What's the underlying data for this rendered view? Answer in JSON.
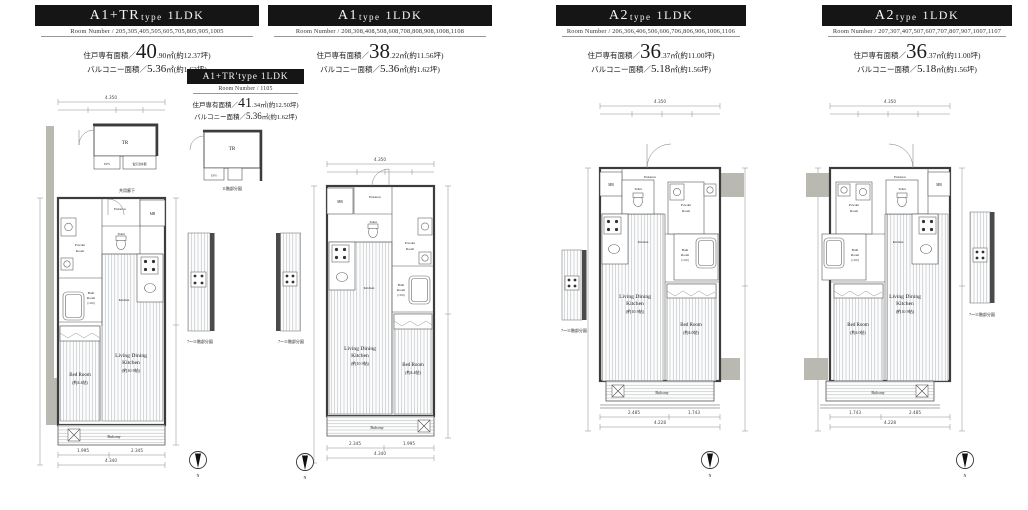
{
  "shared": {
    "compass_n": "N",
    "strip_caption": "7〜11階部分図",
    "tr11_caption": "11階部分図",
    "corridor_label": "共用廊下"
  },
  "plans": [
    {
      "type_big": "A1+TR",
      "type_small": "type",
      "type_tail": "1LDK",
      "room_numbers": "Room Number / 205,305,405,505,605,705,805,905,1005",
      "area_label": "住戸専有面積／",
      "area_int": "40",
      "area_rest": ".90㎡(約12.37坪)",
      "bal_label": "バルコニー面積／",
      "bal_val": "5.36",
      "bal_rest": "㎡(約1.62坪)",
      "rooms": {
        "tr": "TR",
        "eps": "EPS",
        "heater": "電気温水器",
        "entrance": "Entrance",
        "mb": "MB",
        "toilet": "Toilet",
        "powder1": "Powder",
        "powder2": "Room",
        "bath1": "Bath",
        "bath2": "Room",
        "bath3": "(1116)",
        "kitchen": "Kitchen",
        "ldk1": "Living Dining",
        "ldk2": "Kitchen",
        "ldk3": "(約10.9帖)",
        "bed1": "Bed Room",
        "bed2": "(約4.4帖)",
        "balcony": "Balcony"
      },
      "dims": {
        "top_total": "4.350",
        "bottom_a": "1.995",
        "bottom_b": "2.345",
        "bottom_total": "4.340"
      }
    },
    {
      "type_big": "A1",
      "type_small": "type",
      "type_tail": "1LDK",
      "room_numbers": "Room Number / 208,308,408,508,608,708,808,908,1008,1108",
      "area_label": "住戸専有面積／",
      "area_int": "38",
      "area_rest": ".22㎡(約11.56坪)",
      "bal_label": "バルコニー面積／",
      "bal_val": "5.36",
      "bal_rest": "㎡(約1.62坪)",
      "rooms": {
        "entrance": "Entrance",
        "mb": "MB",
        "toilet": "Toilet",
        "powder1": "Powder",
        "powder2": "Room",
        "bath1": "Bath",
        "bath2": "Room",
        "bath3": "(1116)",
        "kitchen": "Kitchen",
        "ldk1": "Living Dining",
        "ldk2": "Kitchen",
        "ldk3": "(約10.9帖)",
        "bed1": "Bed Room",
        "bed2": "(約4.4帖)",
        "balcony": "Balcony"
      },
      "dims": {
        "top_total": "4.350",
        "bottom_a": "2.345",
        "bottom_b": "1.995",
        "bottom_total": "4.340"
      }
    },
    {
      "type_big": "A2",
      "type_small": "type",
      "type_tail": "1LDK",
      "room_numbers": "Room Number / 206,306,406,506,606,706,806,906,1006,1106",
      "area_label": "住戸専有面積／",
      "area_int": "36",
      "area_rest": ".37㎡(約11.00坪)",
      "bal_label": "バルコニー面積／",
      "bal_val": "5.18",
      "bal_rest": "㎡(約1.56坪)",
      "rooms": {
        "entrance": "Entrance",
        "mb": "MB",
        "toilet": "Toilet",
        "powder1": "Powder",
        "powder2": "Room",
        "bath1": "Bath",
        "bath2": "Room",
        "bath3": "(1116)",
        "kitchen": "Kitchen",
        "ldk1": "Living Dining",
        "ldk2": "Kitchen",
        "ldk3": "(約10.9帖)",
        "bed1": "Bed Room",
        "bed2": "(約4.0帖)",
        "balcony": "Balcony"
      },
      "dims": {
        "top_total": "4.350",
        "bottom_a": "2.485",
        "bottom_b": "1.743",
        "bottom_total": "4.228"
      }
    },
    {
      "type_big": "A2",
      "type_small": "type",
      "type_tail": "1LDK",
      "room_numbers": "Room Number / 207,307,407,507,607,707,807,907,1007,1107",
      "area_label": "住戸専有面積／",
      "area_int": "36",
      "area_rest": ".37㎡(約11.00坪)",
      "bal_label": "バルコニー面積／",
      "bal_val": "5.18",
      "bal_rest": "㎡(約1.56坪)",
      "rooms": {
        "entrance": "Entrance",
        "mb": "MB",
        "toilet": "Toilet",
        "powder1": "Powder",
        "powder2": "Room",
        "bath1": "Bath",
        "bath2": "Room",
        "bath3": "(1116)",
        "kitchen": "Kitchen",
        "ldk1": "Living Dining",
        "ldk2": "Kitchen",
        "ldk3": "(約10.9帖)",
        "bed1": "Bed Room",
        "bed2": "(約4.0帖)",
        "balcony": "Balcony"
      },
      "dims": {
        "top_total": "4.350",
        "bottom_a": "1.743",
        "bottom_b": "2.485",
        "bottom_total": "4.228"
      }
    }
  ],
  "sub_plan": {
    "title": "A1+TR'type 1LDK",
    "room_numbers": "Room Number / 1105",
    "area_label": "住戸専有面積／",
    "area_int": "41",
    "area_rest": ".34㎡(約12.50坪)",
    "bal_label": "バルコニー面積／",
    "bal_val": "5.36",
    "bal_rest": "㎡(約1.62坪)"
  }
}
